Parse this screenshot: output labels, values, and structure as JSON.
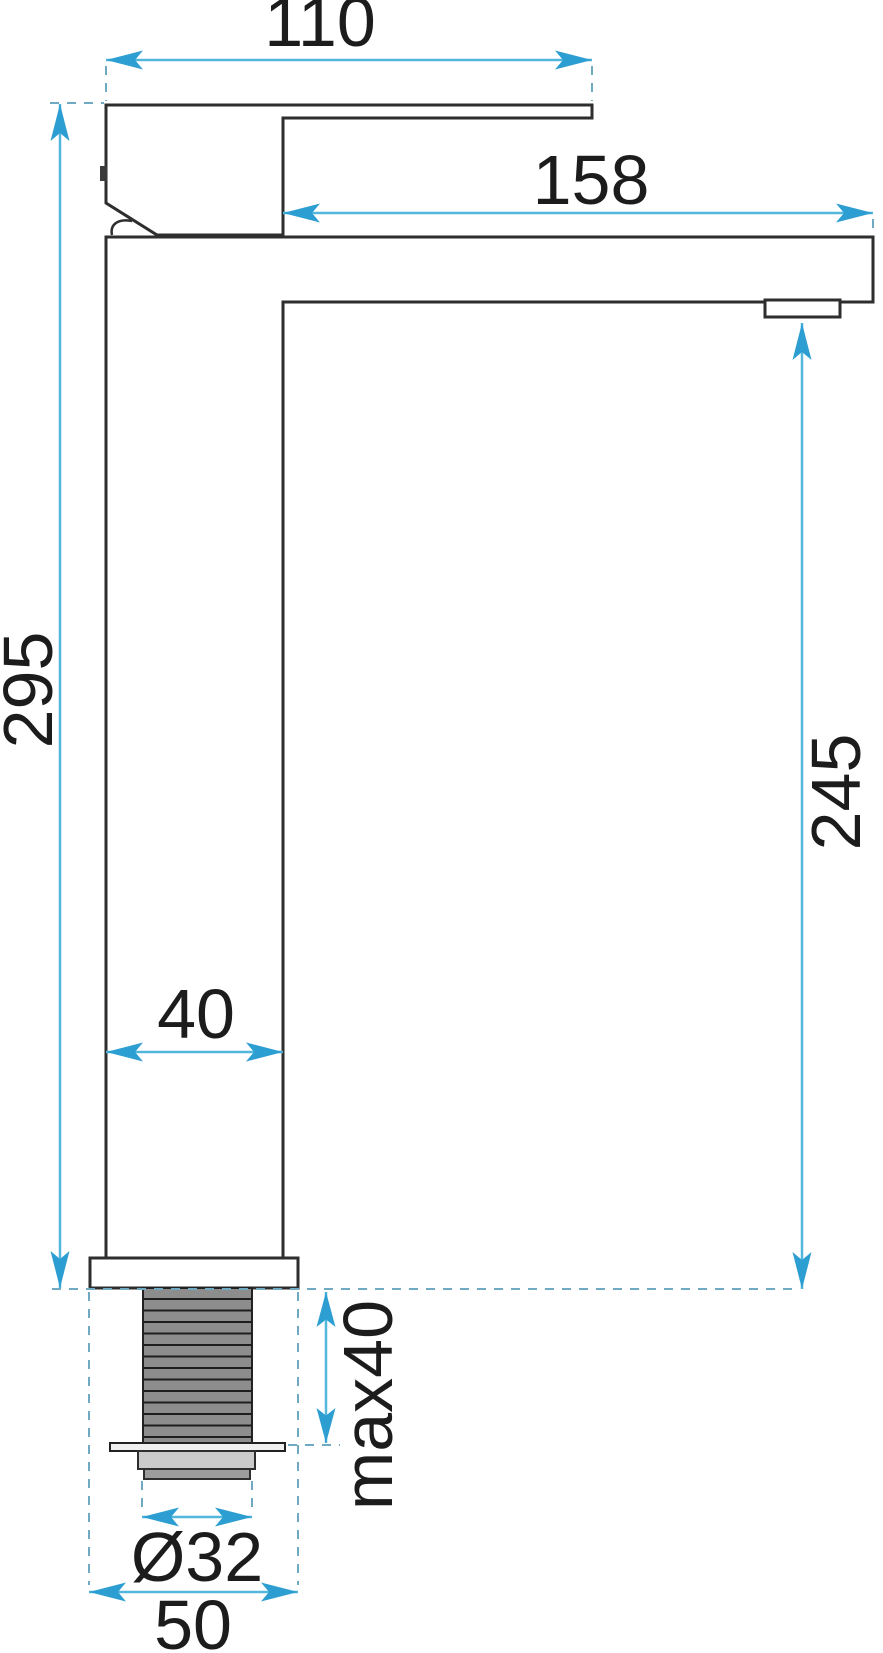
{
  "drawing": {
    "subject": "tall-basin-faucet-technical-drawing",
    "colors": {
      "dimension_line": "#53b7dc",
      "arrowhead": "#2d9ed2",
      "extension_dashed": "#6fa9c2",
      "outline": "#2e2e2e",
      "thread_fill": "#8d8d8d",
      "nut_fill": "#cbcbcb",
      "cap_fill": "#9c9c9c",
      "background": "#ffffff"
    },
    "dimensions": {
      "handle_width": "110",
      "spout_reach": "158",
      "total_height": "295",
      "spout_height": "245",
      "body_width": "40",
      "max_mounting_thickness": "max40",
      "thread_diameter": "Ø32",
      "base_width": "50"
    }
  }
}
